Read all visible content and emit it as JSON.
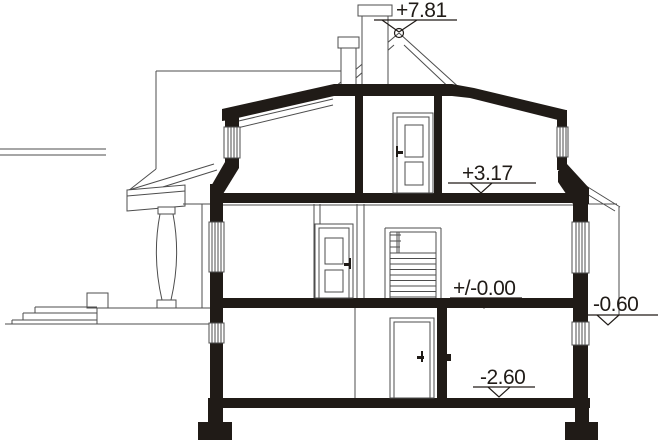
{
  "drawing": {
    "kind": "architectural-cross-section",
    "description": "House vertical section with basement, ground floor, attic, porch and chimney"
  },
  "levels": [
    {
      "name": "ridge",
      "label": "+7.81"
    },
    {
      "name": "attic-floor",
      "label": "+3.17"
    },
    {
      "name": "ground-floor",
      "label": "+/-0.00"
    },
    {
      "name": "grade-right",
      "label": "-0.60"
    },
    {
      "name": "basement-floor",
      "label": "-2.60"
    }
  ],
  "colors": {
    "ink": "#201b17",
    "line": "#4d4d4d",
    "paper": "#ffffff"
  }
}
